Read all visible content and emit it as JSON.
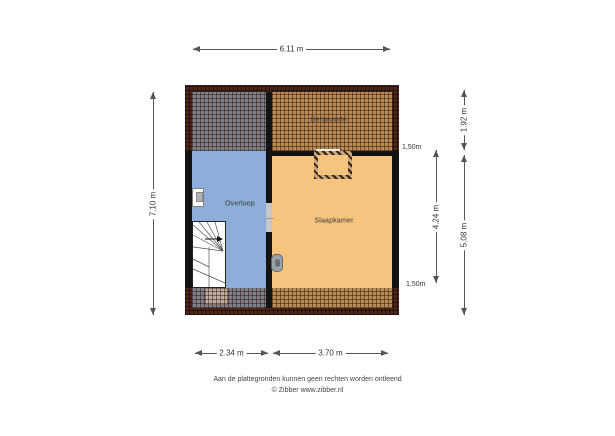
{
  "floorplan": {
    "rooms": {
      "bergruimte": {
        "label": "Bergruimte"
      },
      "overloop": {
        "label": "Overloop"
      },
      "slaapkamer": {
        "label": "Slaapkamer"
      }
    },
    "height_markers": {
      "top": "1,50m",
      "bottom": "1,50m"
    },
    "features": {
      "stairs": "winder-staircase-icon",
      "stair_direction": "arrow-icon",
      "door_opening": "door-opening",
      "door_handle": "door-handle-icon",
      "wall_unit": "wall-unit-icon",
      "chimney": "chimney-shaft"
    }
  },
  "dimensions": {
    "top_width": "6.11 m",
    "left_height": "7.10 m",
    "right_upper": "1.92 m",
    "right_lower": "5.08 m",
    "right_inner": "4.24 m",
    "bottom_left_room": "2.34 m",
    "bottom_right_room": "3.70 m"
  },
  "footer": {
    "disclaimer": "Aan de plattegronden kunnen geen rechten worden ontleend",
    "credit": "© Zibber www.zibber.nl"
  },
  "colors": {
    "floor_overloop": "#8caed9",
    "floor_slaapkamer": "#f5c47e",
    "roof_band": "#4e2718",
    "wall": "#141414",
    "dimension_line": "#555555"
  }
}
